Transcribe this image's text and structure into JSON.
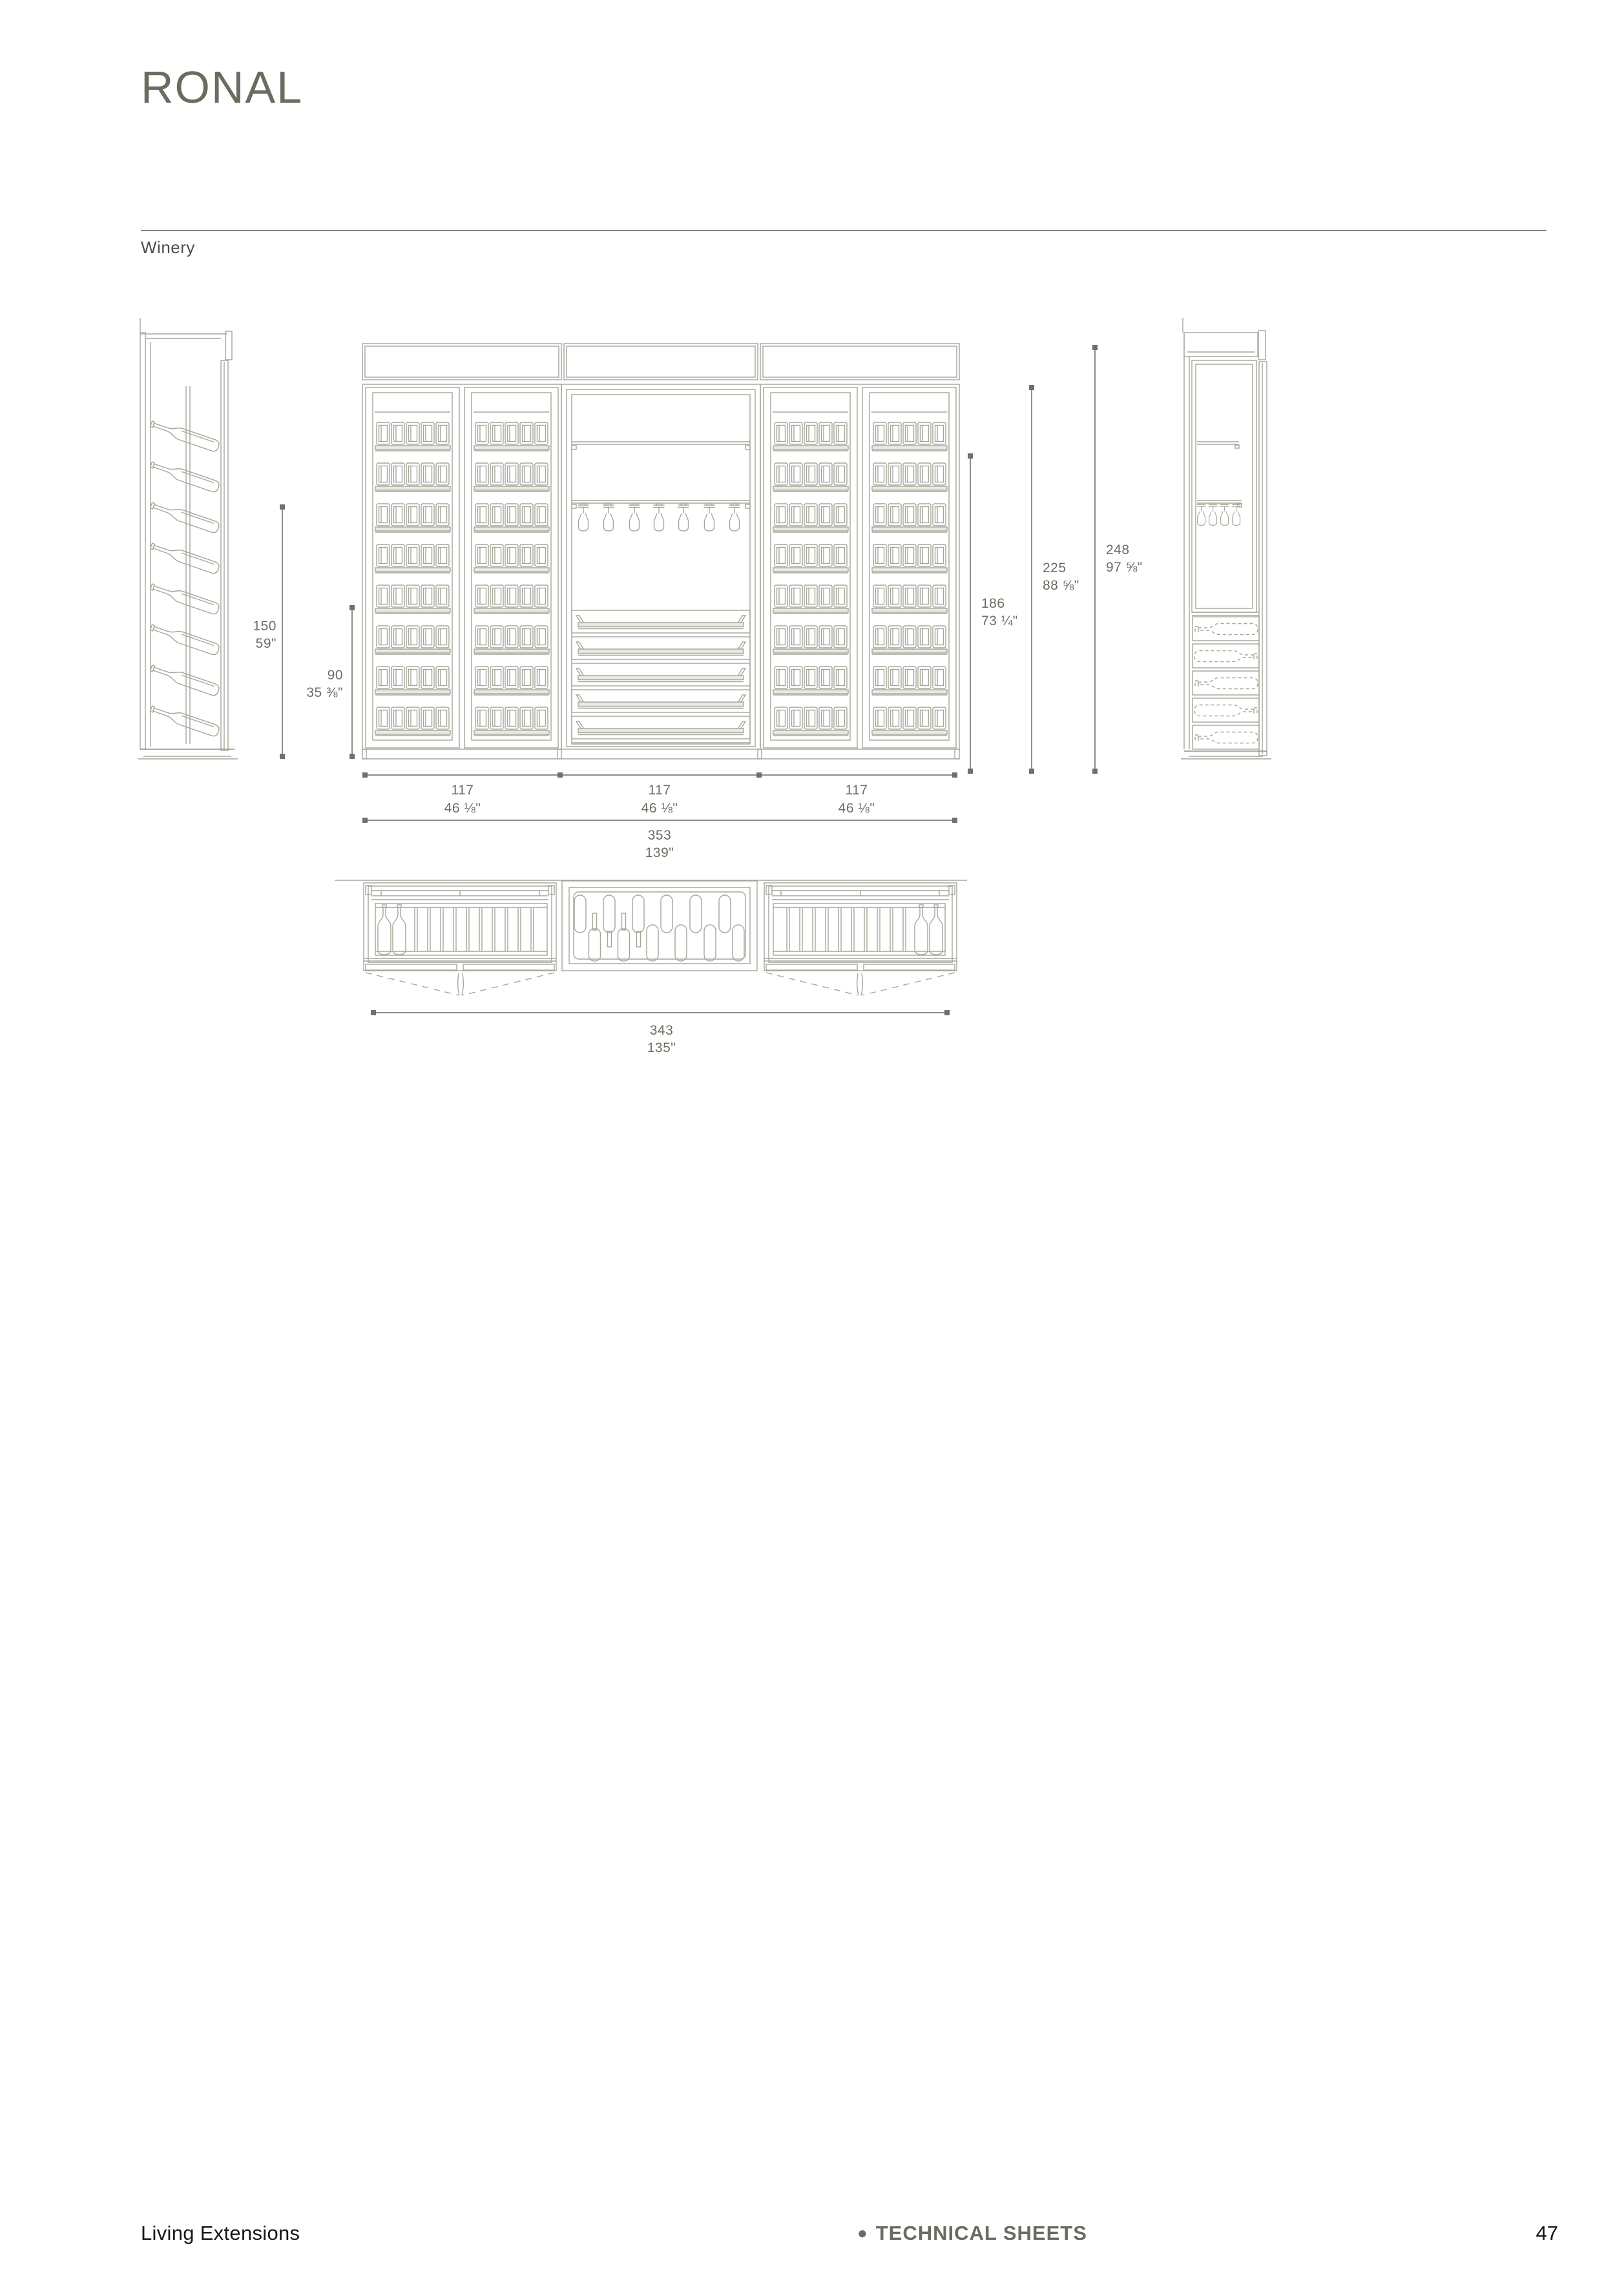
{
  "header": {
    "title": "RONAL",
    "subtitle": "Winery"
  },
  "footer": {
    "left": "Living Extensions",
    "bullet": "●",
    "center": "TECHNICAL SHEETS",
    "page_number": "47"
  },
  "drawing": {
    "views": [
      "side-section-left",
      "front-elevation",
      "side-section-right",
      "plan-view"
    ],
    "content": "winery wall system: bottle racks, glass-door bottle shelves, stemware rails, pull-out trays, bottle drawers"
  },
  "dims": {
    "side_height": {
      "cm": "150",
      "in": "59\""
    },
    "base_unit_height": {
      "cm": "90",
      "in": "35 ⅜\""
    },
    "door_height": {
      "cm": "186",
      "in": "73 ¼\""
    },
    "cabinet_height": {
      "cm": "225",
      "in": "88 ⅝\""
    },
    "total_height": {
      "cm": "248",
      "in": "97 ⅝\""
    },
    "module_width": {
      "cm": "117",
      "in": "46 ⅛\""
    },
    "total_width": {
      "cm": "353",
      "in": "139\""
    },
    "plan_width": {
      "cm": "343",
      "in": "135\""
    }
  },
  "colors": {
    "accent": "#6b6b60",
    "drawing_line": "#a6a69b",
    "dim_line": "#7d7d74",
    "dim_text": "#6d6d63",
    "footer_text": "#161614"
  }
}
